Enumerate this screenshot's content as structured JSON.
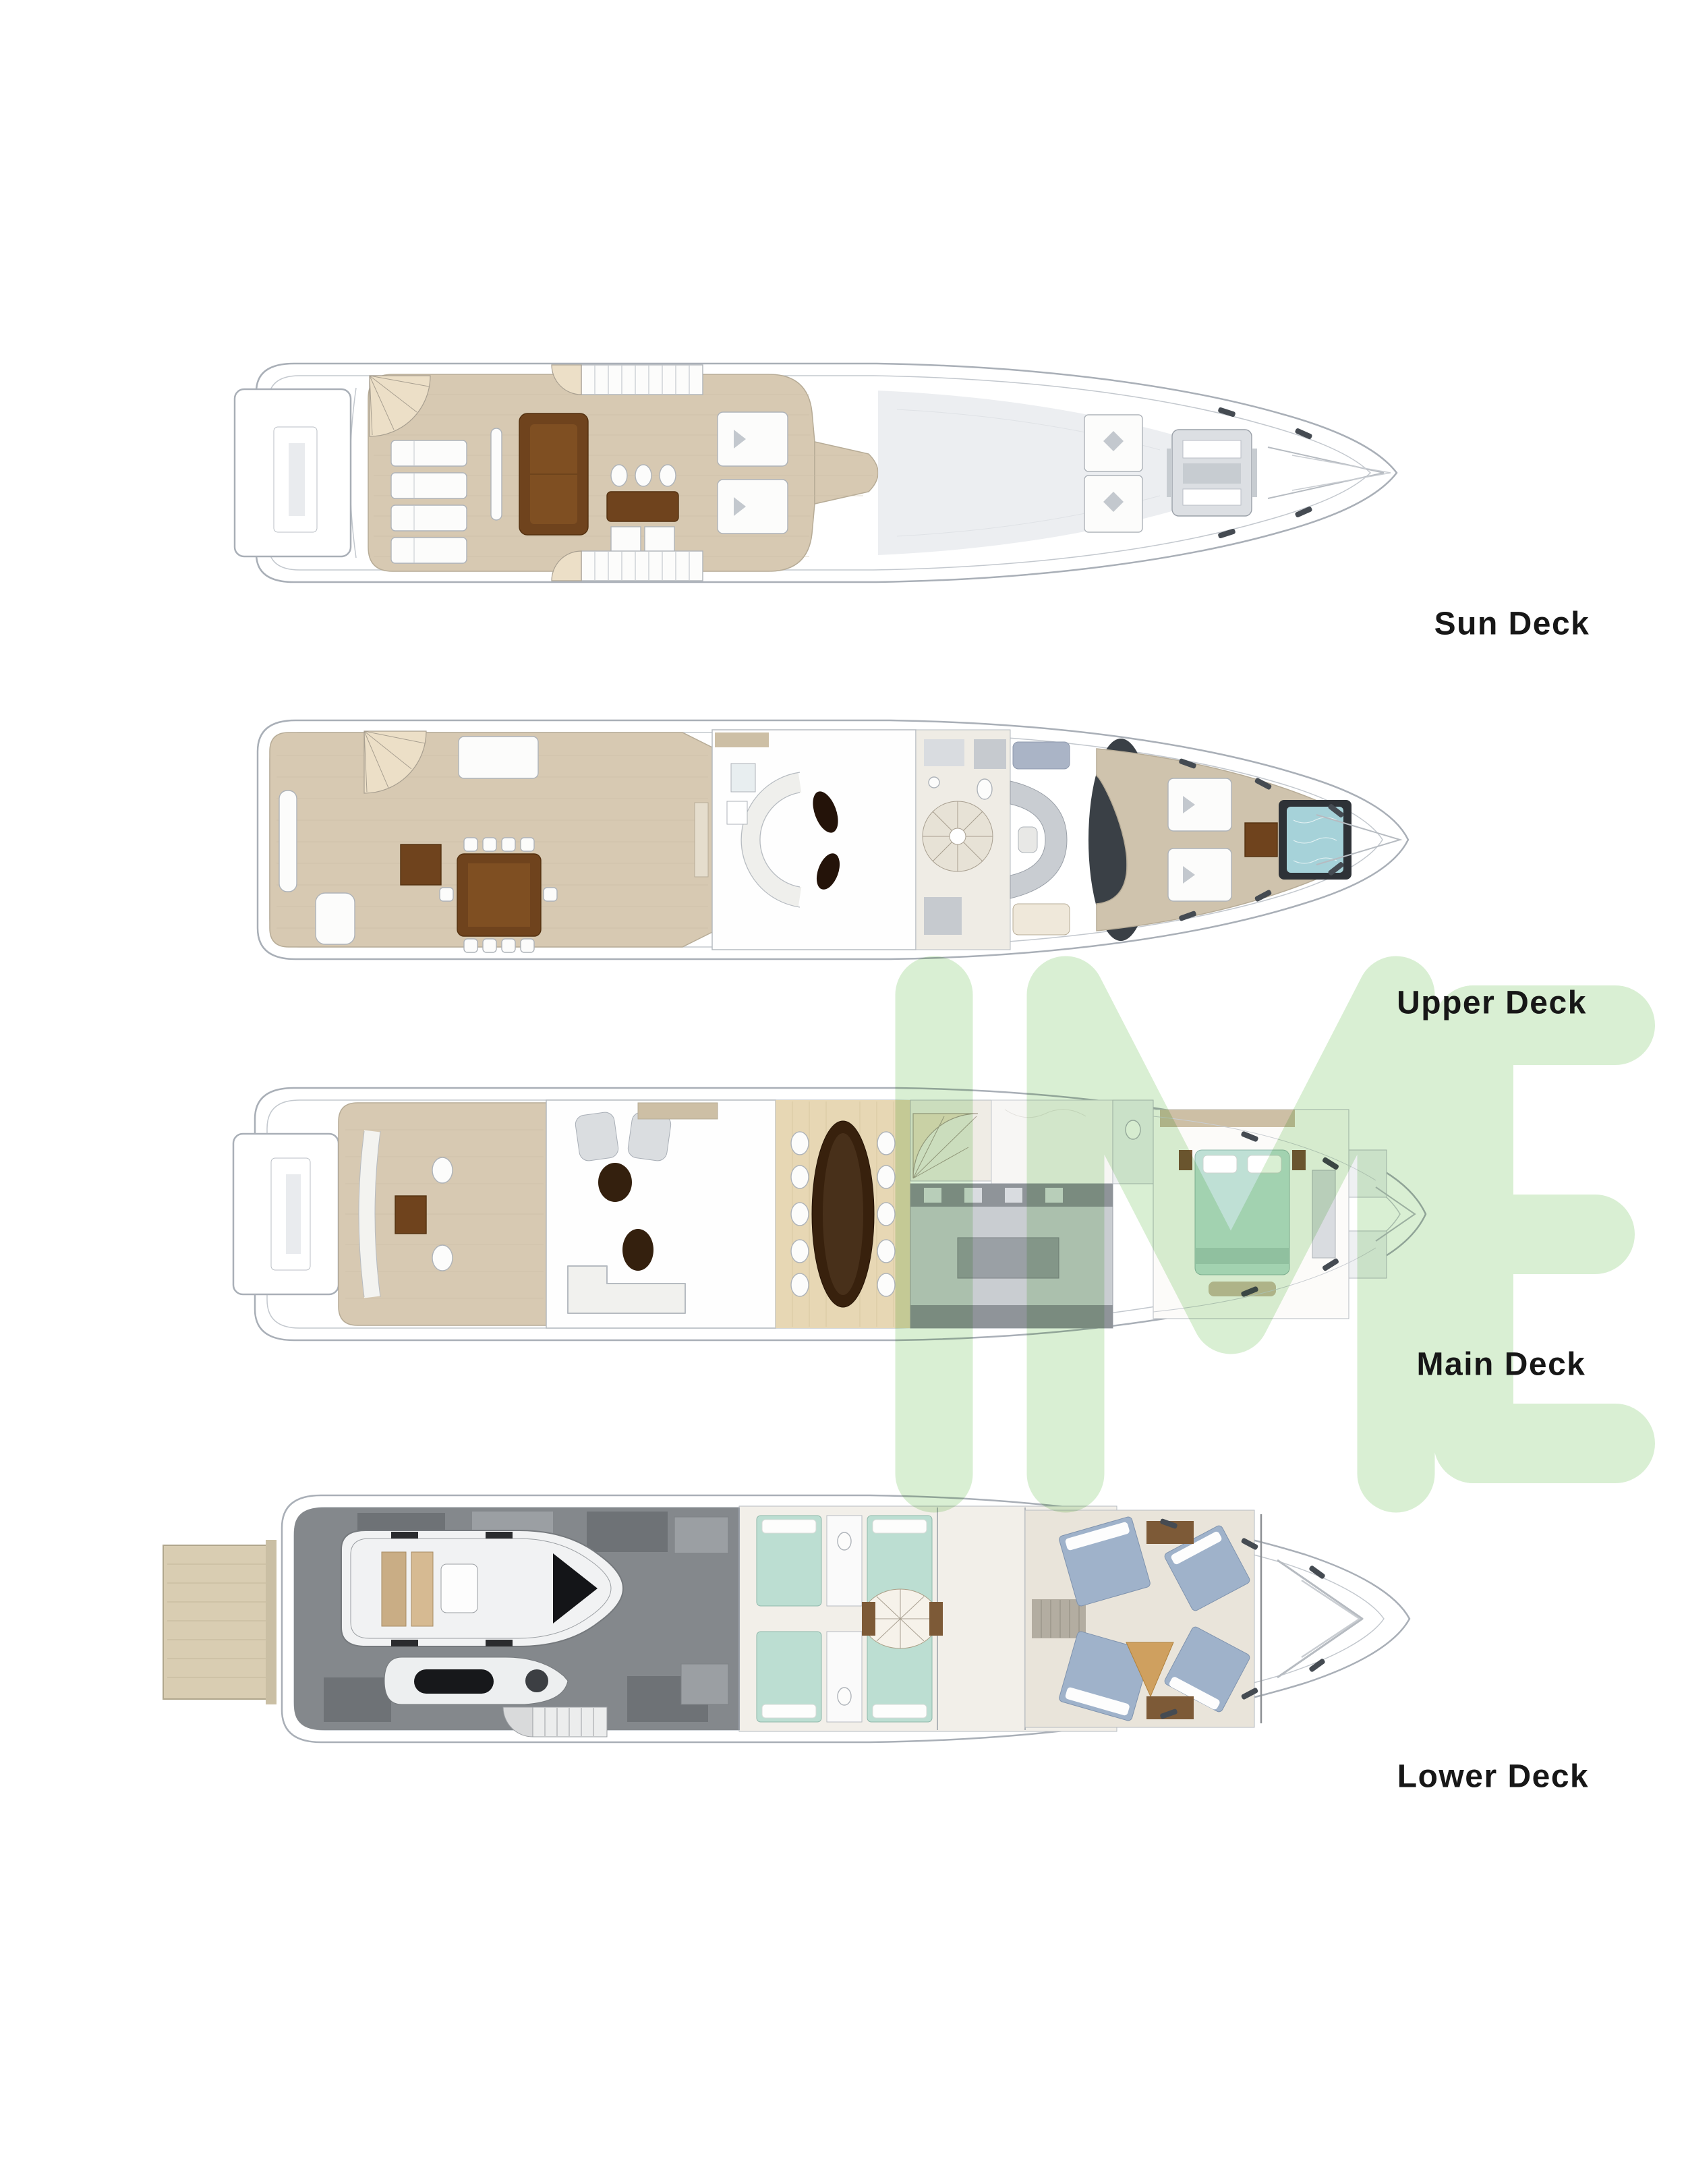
{
  "decks": [
    {
      "id": "sun-deck",
      "label": "Sun Deck"
    },
    {
      "id": "upper-deck",
      "label": "Upper Deck"
    },
    {
      "id": "main-deck",
      "label": "Main Deck"
    },
    {
      "id": "lower-deck",
      "label": "Lower Deck"
    }
  ],
  "watermark": {
    "text": "IME",
    "color": "#d9efd3"
  },
  "colors": {
    "background": "#ffffff",
    "label_text": "#171717",
    "teak_deck": "#d7c9b2",
    "wood_floor": "#e7d7b4",
    "furniture_brown": "#6f431d",
    "dining_table_dark": "#38210d",
    "master_bed_teal": "#bfe0d5",
    "guest_bed_teal": "#bcded2",
    "crew_bed_blue": "#9fb2ca",
    "jacuzzi_teal": "#a6d2d9",
    "garage_gray": "#84888c",
    "hull_line_gray": "#a9afb7",
    "watermark_green": "#d9efd3"
  }
}
